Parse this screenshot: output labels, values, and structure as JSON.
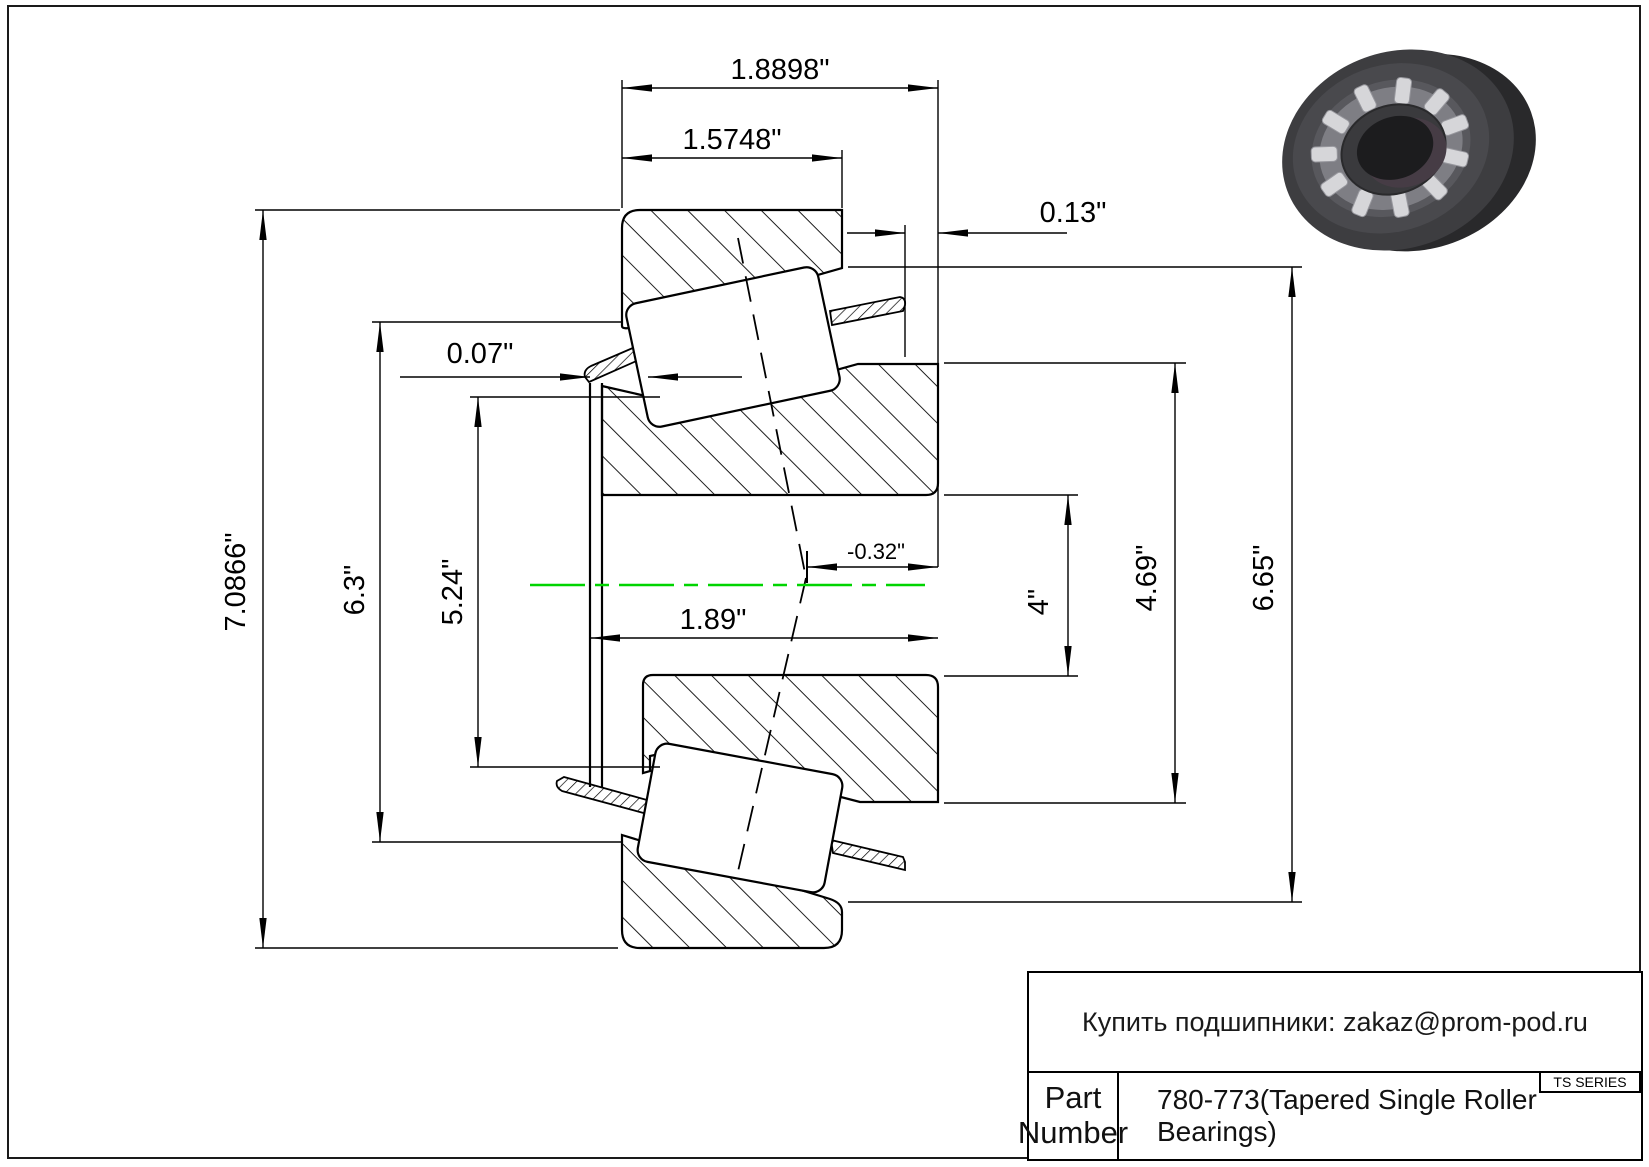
{
  "dims": {
    "w_outer": "1.8898\"",
    "w_cup": "1.5748\"",
    "back_offset": "0.13\"",
    "front_offset": "0.07\"",
    "od": "7.0866\"",
    "d_flange": "6.3\"",
    "d_rib": "5.24\"",
    "w_cone": "1.89\"",
    "eff_center": "-0.32\"",
    "bore": "4\"",
    "d_cone_back": "4.69\"",
    "d_cup_front": "6.65\""
  },
  "title_block": {
    "contact": "Купить подшипники: zakaz@prom-pod.ru",
    "series": "TS SERIES",
    "part_label_line1": "Part",
    "part_label_line2": "Number",
    "part_value": "780-773(Tapered Single Roller Bearings)"
  },
  "colors": {
    "centerline": "#00d400",
    "line": "#000000"
  }
}
